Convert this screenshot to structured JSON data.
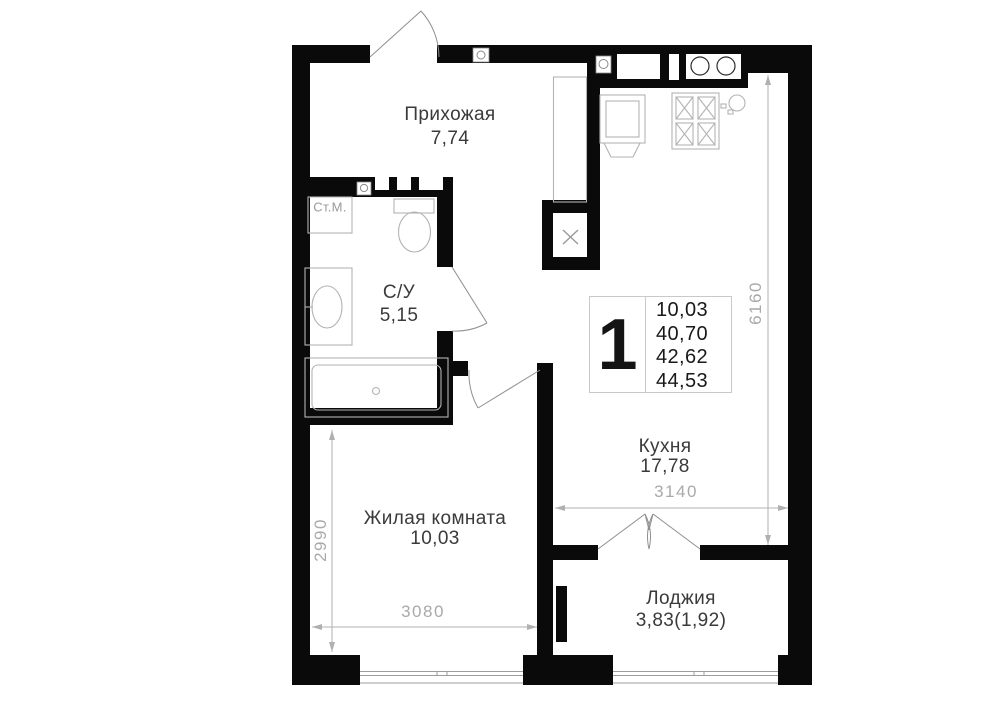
{
  "badge": {
    "number": "1",
    "areas": [
      "10,03",
      "40,70",
      "42,62",
      "44,53"
    ]
  },
  "rooms": {
    "hallway": {
      "name": "Прихожая",
      "area": "7,74"
    },
    "bathroom": {
      "name": "С/У",
      "area": "5,15"
    },
    "kitchen": {
      "name": "Кухня",
      "area": "17,78"
    },
    "living": {
      "name": "Жилая комната",
      "area": "10,03"
    },
    "loggia": {
      "name": "Лоджия",
      "area": "3,83(1,92)"
    }
  },
  "fixtures": {
    "washing_machine": "Ст.М."
  },
  "dimensions": {
    "kitchen_depth": "6160",
    "kitchen_width": "3140",
    "living_depth": "2990",
    "living_width": "3080"
  },
  "colors": {
    "wall": "#0a0a0a",
    "furniture_line": "#b3b3b3",
    "dimension_line": "#b0b0b0",
    "dimension_text": "#a9a9a9",
    "room_text": "#3a3a3a",
    "badge_border": "#c9c9c9"
  }
}
